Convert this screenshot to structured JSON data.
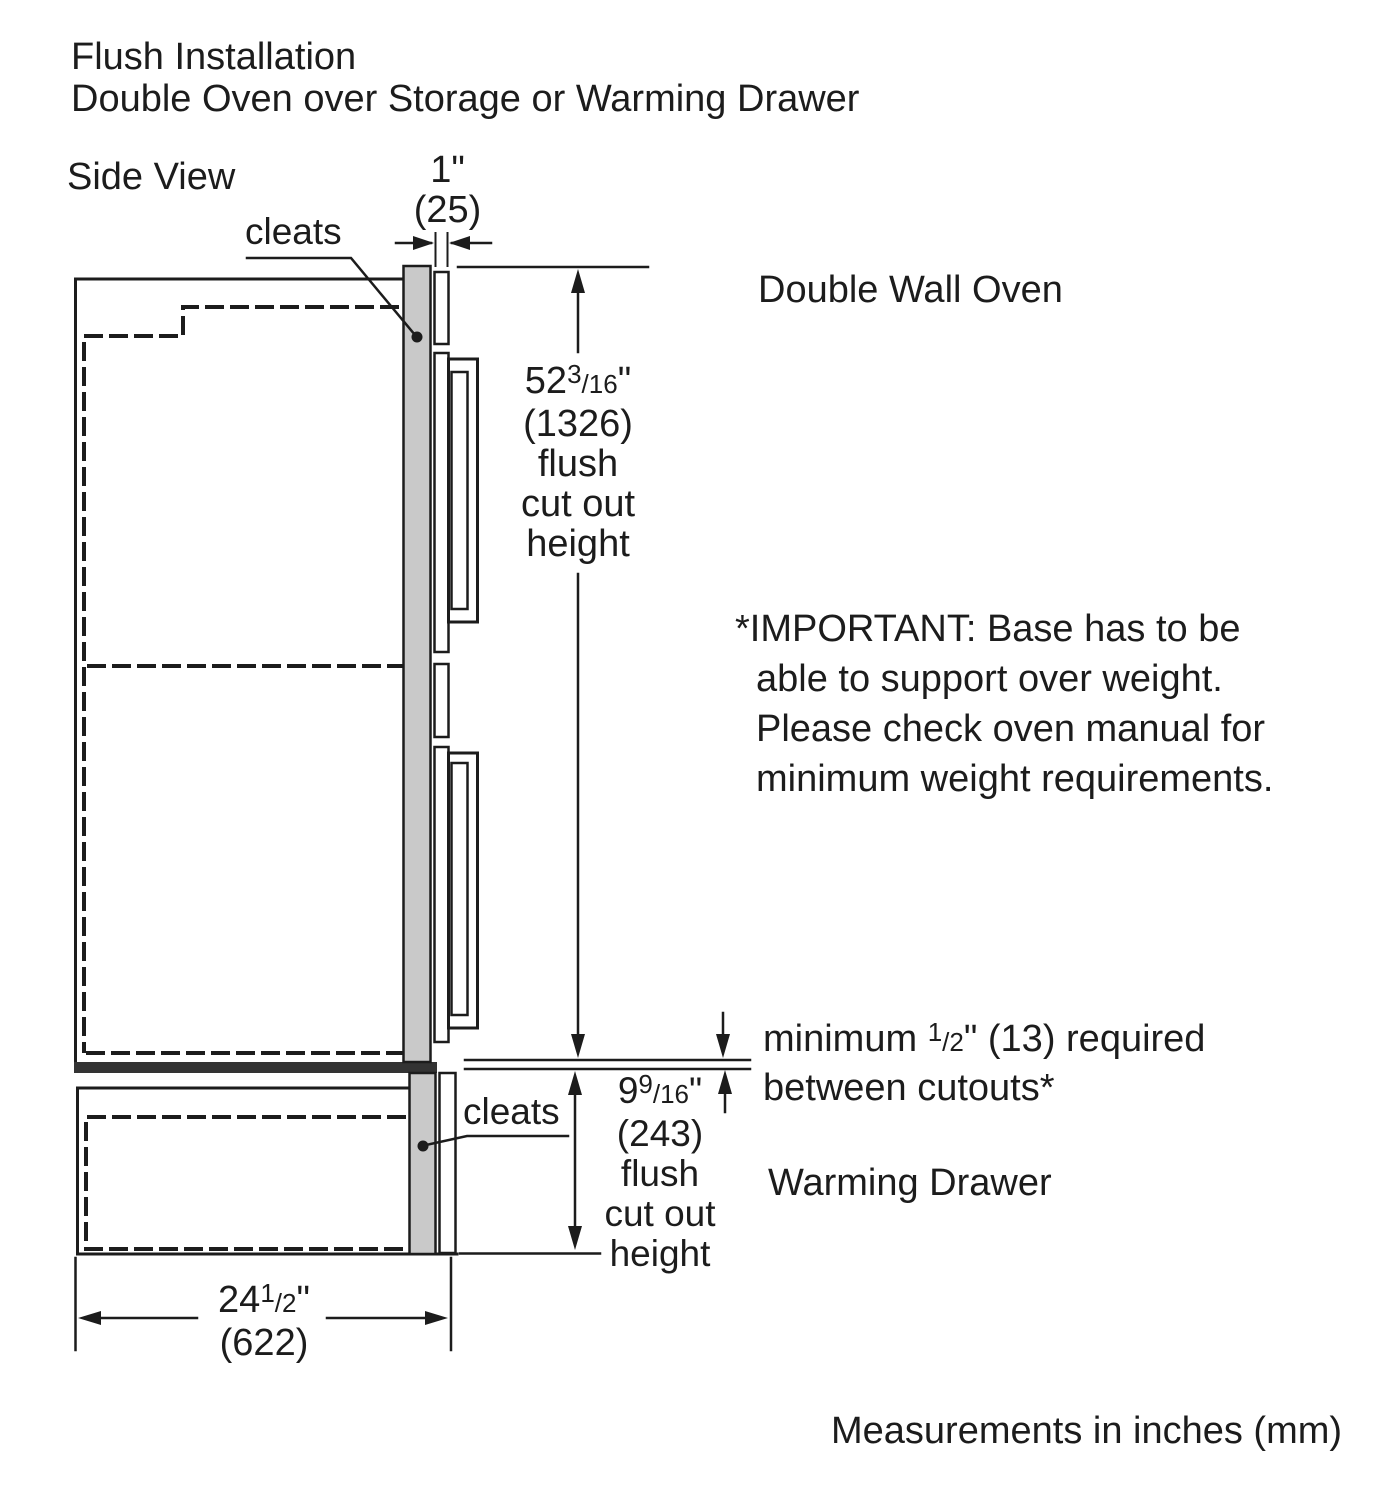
{
  "page": {
    "title_line1": "Flush Installation",
    "title_line2": "Double Oven over Storage or Warming Drawer",
    "view_label": "Side View",
    "footer_note": "Measurements in inches (mm)"
  },
  "labels": {
    "cleats_top": "cleats",
    "cleats_bottom": "cleats",
    "double_wall_oven": "Double Wall Oven",
    "warming_drawer": "Warming Drawer"
  },
  "dimensions": {
    "cleat_thickness": {
      "inches": "1\"",
      "mm": "(25)"
    },
    "oven_cutout": {
      "whole": "52",
      "numerator": "3",
      "denominator": "/16",
      "unit": "\"",
      "mm": "(1326)",
      "caption": [
        "flush",
        "cut out",
        "height"
      ]
    },
    "drawer_cutout": {
      "whole": "9",
      "numerator": "9",
      "denominator": "/16",
      "unit": "\"",
      "mm": "(243)",
      "caption": [
        "flush",
        "cut out",
        "height"
      ]
    },
    "cabinet_depth": {
      "whole": "24",
      "numerator": "1",
      "denominator": "/2",
      "unit": "\"",
      "mm": "(622)"
    }
  },
  "notes": {
    "important": [
      "*IMPORTANT: Base has to be",
      "able to support over weight.",
      "Please check oven manual for",
      "minimum weight requirements."
    ],
    "min_gap_pre": "minimum ",
    "min_gap_numerator": "1",
    "min_gap_denominator": "/2",
    "min_gap_post": "\" (13) required",
    "min_gap_line2": "between cutouts*"
  },
  "colors": {
    "line": "#1c1c1c",
    "cleat_fill": "#c9c9c9",
    "divider_fill": "#333333",
    "background": "#ffffff"
  }
}
